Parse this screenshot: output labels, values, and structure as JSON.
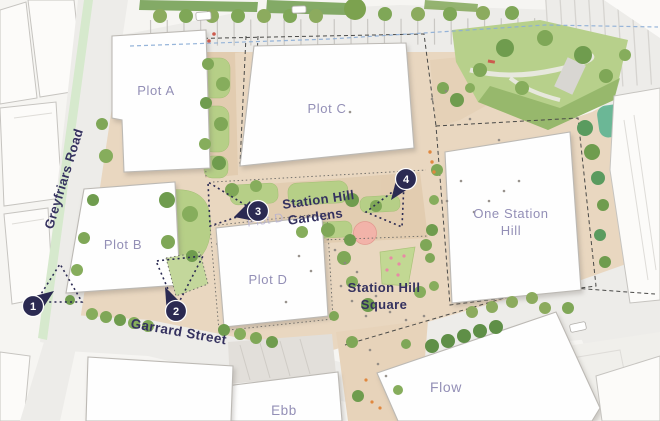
{
  "colors": {
    "marker_navy": "#2b2a52",
    "label_navy": "#34315f",
    "plot_label_purple": "#938fb6",
    "plot_label_faint": "#b6b1d2",
    "site_beige": "#e9d7c0",
    "lawn_green": "#b6cf87",
    "tree_green": "#7fa757",
    "teal_green": "#55b28e",
    "cycle_lane_green": "#d6e9cd",
    "road_gray": "#edece9",
    "pink_plaza": "#f2b3a9",
    "route_blue": "#8badd6"
  },
  "roads": {
    "greyfriars": "Greyfriars Road",
    "garrard": "Garrard Street"
  },
  "places": {
    "gardens": {
      "line1": "Station Hill",
      "line2": "Gardens"
    },
    "square": {
      "line1": "Station Hill",
      "line2": "Square"
    }
  },
  "plots": {
    "a": "Plot A",
    "b": "Plot B",
    "c": "Plot C",
    "d": "Plot D",
    "d_upper": "Plot D"
  },
  "buildings": {
    "one_station_hill": {
      "line1": "One Station",
      "line2": "Hill"
    },
    "ebb": "Ebb",
    "flow": "Flow"
  },
  "markers": [
    {
      "number": "1"
    },
    {
      "number": "2"
    },
    {
      "number": "3"
    },
    {
      "number": "4"
    }
  ]
}
